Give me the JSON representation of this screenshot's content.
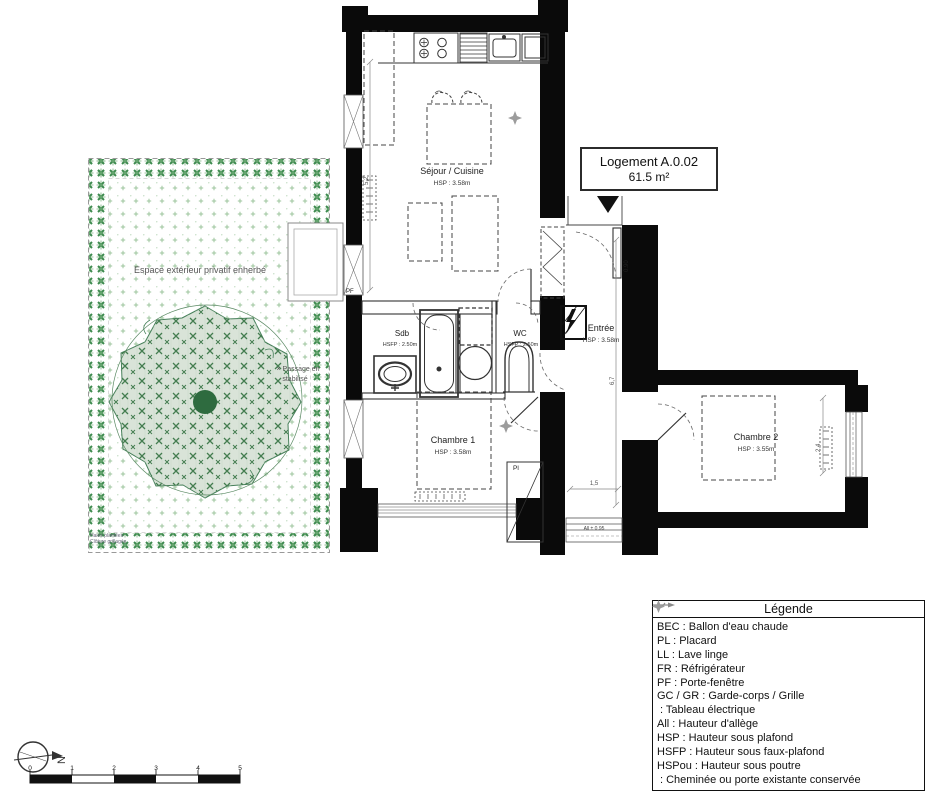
{
  "plan": {
    "title_box": {
      "name": "Logement A.0.02",
      "area": "61.5 m²"
    },
    "rooms": [
      {
        "id": "sejour",
        "label": "Séjour / Cuisine",
        "height": "HSP : 3.58m"
      },
      {
        "id": "sdb",
        "label": "Sdb",
        "height": "HSFP : 2.50m"
      },
      {
        "id": "wc",
        "label": "WC",
        "height": "HSFP : 2.50m"
      },
      {
        "id": "entree",
        "label": "Entrée",
        "height": "HSP : 3.58m"
      },
      {
        "id": "chambre1",
        "label": "Chambre 1",
        "height": "HSP : 3.58m"
      },
      {
        "id": "chambre2",
        "label": "Chambre 2",
        "height": "HSP : 3.55m"
      }
    ],
    "labels": {
      "placard": "Pl",
      "porte_fenetre": "PF",
      "door_width": "0.90",
      "allege": "All ± 0.95",
      "dim_sejour": "5,2",
      "dim_entree": "6,7",
      "dim_chambre2": "2,4",
      "dim_corridor": "1,5"
    }
  },
  "garden": {
    "title": "Espace extérieur privatif enherbé",
    "passage1": "× Passage en",
    "passage2": "stabilisé",
    "hedge1": "Haies plantées",
    "hedge2": "Clôture grillagée"
  },
  "legend": {
    "title": "Légende",
    "items": [
      "BEC : Ballon d'eau chaude",
      "PL : Placard",
      "LL : Lave linge",
      "FR : Réfrigérateur",
      "PF : Porte-fenêtre",
      "GC / GR : Garde-corps / Grille",
      ": Tableau électrique",
      "All : Hauteur d'allège",
      "HSP : Hauteur sous plafond",
      "HSFP : Hauteur sous faux-plafond",
      "HSPou : Hauteur sous poutre",
      ": Cheminée ou porte existante conservée"
    ],
    "icons": {
      "tableau_electrique": "arrow-line-icon",
      "cheminee": "four-point-star-icon"
    }
  },
  "compass": {
    "north": "N"
  },
  "scalebar": {
    "ticks": [
      "0",
      "1",
      "2",
      "3",
      "4",
      "5"
    ]
  },
  "colors": {
    "wall": "#0a0a0a",
    "line": "#444444",
    "garden_border_green": "#3d8a4e",
    "garden_dot_green": "#9cc49c",
    "tree_fill": "#d9e3d8",
    "tree_mark": "#447d50",
    "tree_trunk": "#2e6b3f",
    "diamond_gray": "#9c9c9c"
  }
}
